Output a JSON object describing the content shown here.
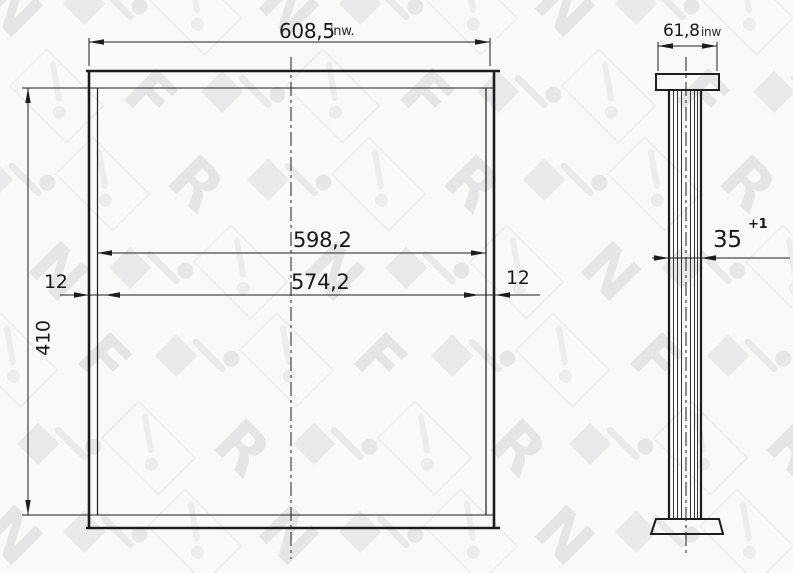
{
  "drawing": {
    "front_view": {
      "total_width": {
        "value": "608,5",
        "unit": "inw."
      },
      "inner_width": "598,2",
      "tube_width": "574,2",
      "offset_left": "12",
      "offset_right": "12",
      "core_height": "410"
    },
    "side_view": {
      "total_depth": {
        "value": "61,8",
        "unit": "inw"
      },
      "core_thickness": {
        "value": "35",
        "tolerance": "+1"
      }
    }
  },
  "watermark": {
    "letters": [
      "N",
      "R",
      "F"
    ]
  },
  "colors": {
    "line": "#1d1d1d",
    "watermark": "#e5e5e5",
    "background": "#f9f9f8"
  }
}
